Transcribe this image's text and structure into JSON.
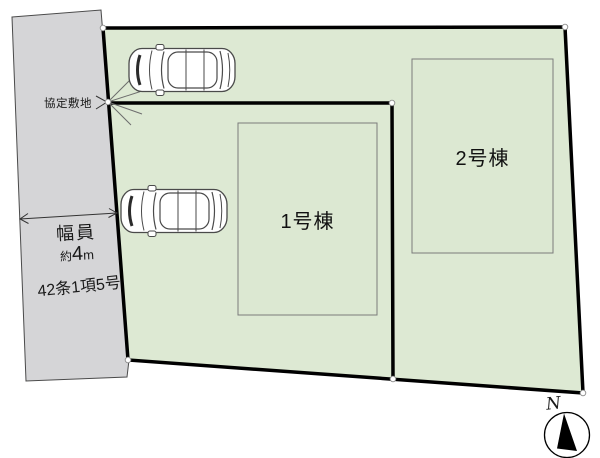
{
  "site_plan": {
    "road": {
      "easement_label": "協定敷地",
      "width_label": "幅員",
      "width_value": {
        "prefix": "約",
        "number": "4",
        "unit": "m"
      },
      "article_label": "42条1項5号"
    },
    "buildings": [
      {
        "label": "1号棟"
      },
      {
        "label": "2号棟"
      }
    ],
    "compass": {
      "north_label": "N"
    },
    "icons": [
      "car-top-view-icon",
      "compass-north-icon",
      "corner-marker-dot",
      "dimension-arrow",
      "leader-arrow-icon"
    ],
    "colors": {
      "plot_fill": "#dde9d3",
      "road_fill": "#d5d5d7",
      "boundary_line": "#000000",
      "building_border": "#7b7b7b",
      "thin_line": "#4a4a4a"
    }
  }
}
